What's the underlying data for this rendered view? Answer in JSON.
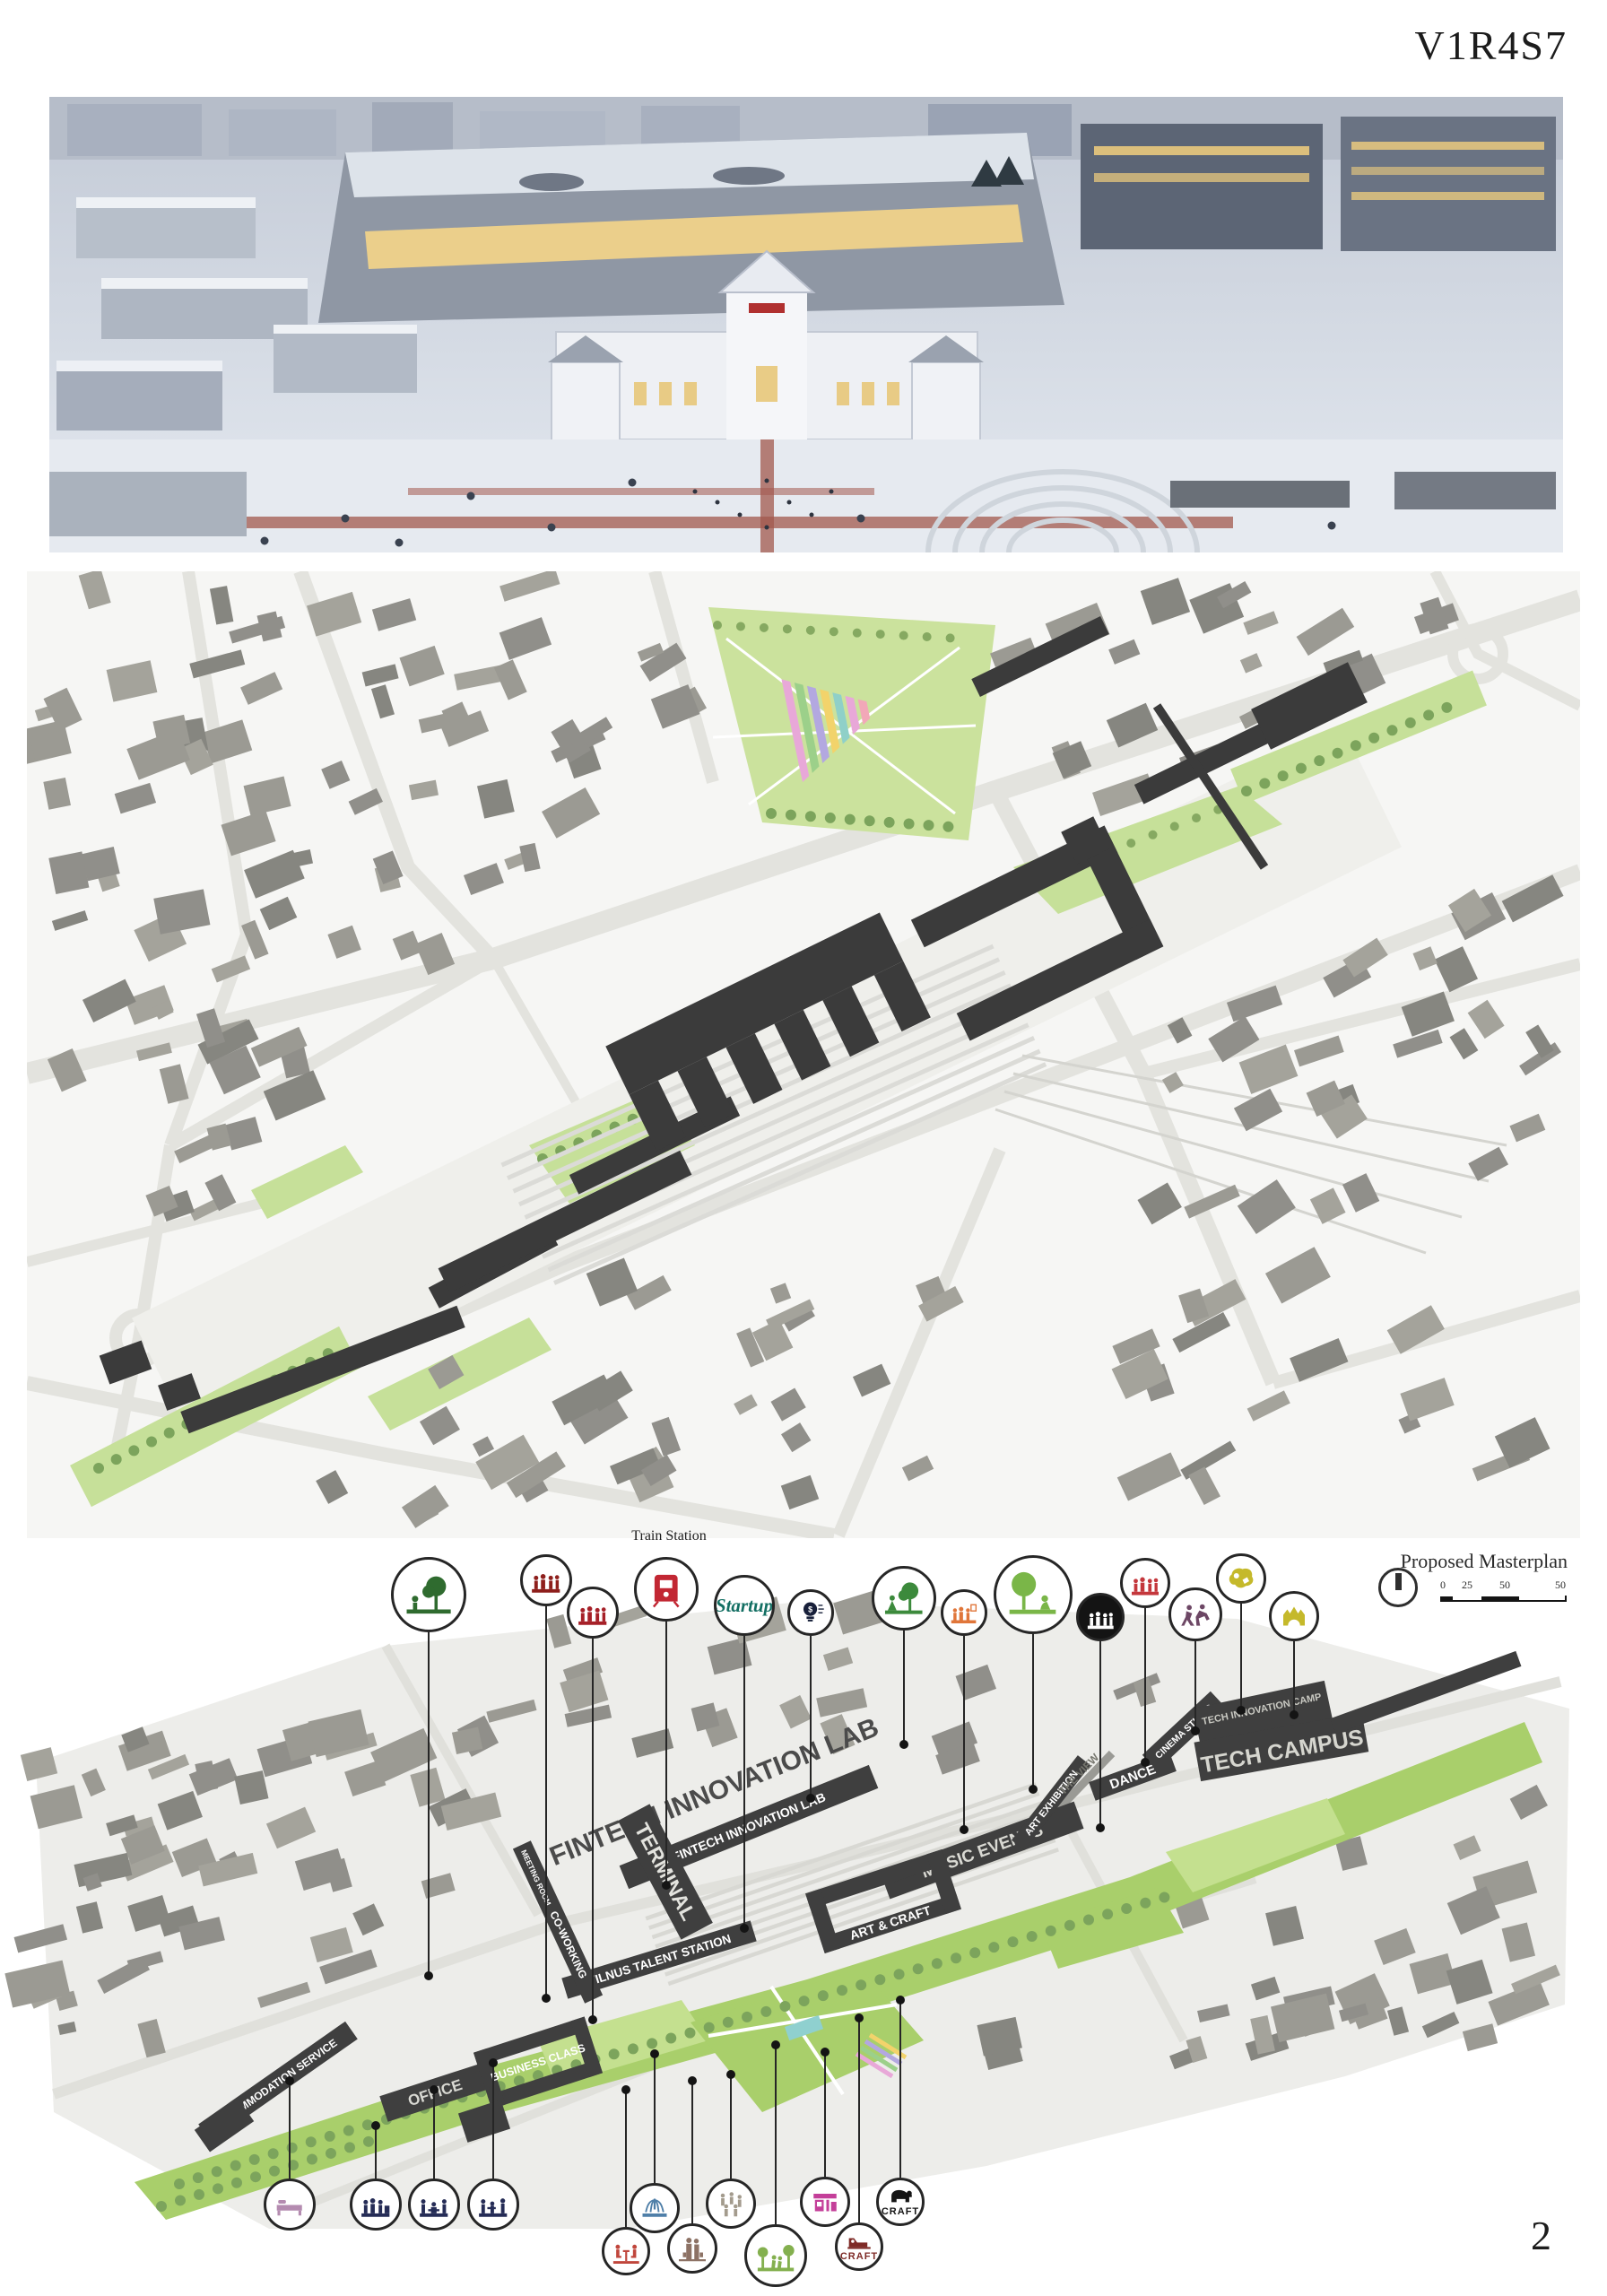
{
  "page": {
    "code": "V1R4S7",
    "number": "2"
  },
  "masterplan": {
    "title": "Proposed Masterplan",
    "scale_ticks": [
      "0",
      "25",
      "50",
      "50"
    ]
  },
  "axon": {
    "train_station_label": "Train Station",
    "labels": [
      "FINTECH INNOVATION LAB",
      "TERMINAL",
      "VILNUS TALENT STATION",
      "CO-WORKING",
      "MEETING ROOM",
      "MUSIC EVENTS",
      "ART & CRAFT",
      "ART EXHIBITION",
      "THE VIEW",
      "DANCE",
      "CINEMA STUDIO",
      "TECH INNOVATION CAMP",
      "TECH CAMPUS",
      "ACOMMODATION SERVICE",
      "OFFICE",
      "BUSINESS CLASS"
    ],
    "top_icons": [
      {
        "name": "park-dog-icon",
        "color": "#2f6b2f"
      },
      {
        "name": "market-crowd-icon",
        "color": "#8e1f1c"
      },
      {
        "name": "platform-crowd-icon",
        "color": "#a62028"
      },
      {
        "name": "train-station-icon",
        "color": "#c22733"
      },
      {
        "name": "startup-logo-icon",
        "color": "#136f63",
        "label": "Startup"
      },
      {
        "name": "fintech-bulb-icon",
        "color": "#18203a",
        "label": "$"
      },
      {
        "name": "yoga-park-icon",
        "color": "#3c8a3c"
      },
      {
        "name": "gallery-visitors-icon",
        "color": "#e0763a"
      },
      {
        "name": "community-garden-icon",
        "color": "#7ab648"
      },
      {
        "name": "concert-crowd-icon",
        "color": "#ffffff",
        "bg": "#141414"
      },
      {
        "name": "sports-group-icon",
        "color": "#c4373c"
      },
      {
        "name": "dance-figures-icon",
        "color": "#6d4765"
      },
      {
        "name": "city-blob-icon",
        "color": "#c5b92b"
      },
      {
        "name": "crown-blob-icon",
        "color": "#c5b92b"
      }
    ],
    "bottom_icons": [
      {
        "name": "bedroom-icon",
        "color": "#b48bb0"
      },
      {
        "name": "office-team-icon",
        "color": "#252c56"
      },
      {
        "name": "office-meeting-icon",
        "color": "#252c56"
      },
      {
        "name": "office-desks-icon",
        "color": "#252c56"
      },
      {
        "name": "cafe-diners-icon",
        "color": "#c0463c"
      },
      {
        "name": "fountain-icon",
        "color": "#4f7fa8"
      },
      {
        "name": "shopping-couple-icon",
        "color": "#8d7265"
      },
      {
        "name": "walking-crowd-icon",
        "color": "#a39b8d"
      },
      {
        "name": "park-joggers-icon",
        "color": "#84b04f"
      },
      {
        "name": "market-stall-icon",
        "color": "#c43f99"
      },
      {
        "name": "craft-sewing-icon",
        "color": "#7e2a26",
        "label": "CRAFT"
      },
      {
        "name": "craft-elephant-icon",
        "color": "#151515",
        "label": "CRAFT"
      }
    ]
  },
  "colors": {
    "proposed_building": "#3f3f3f",
    "green_space": "#a9cf6b",
    "paper": "#f6f6f4"
  }
}
